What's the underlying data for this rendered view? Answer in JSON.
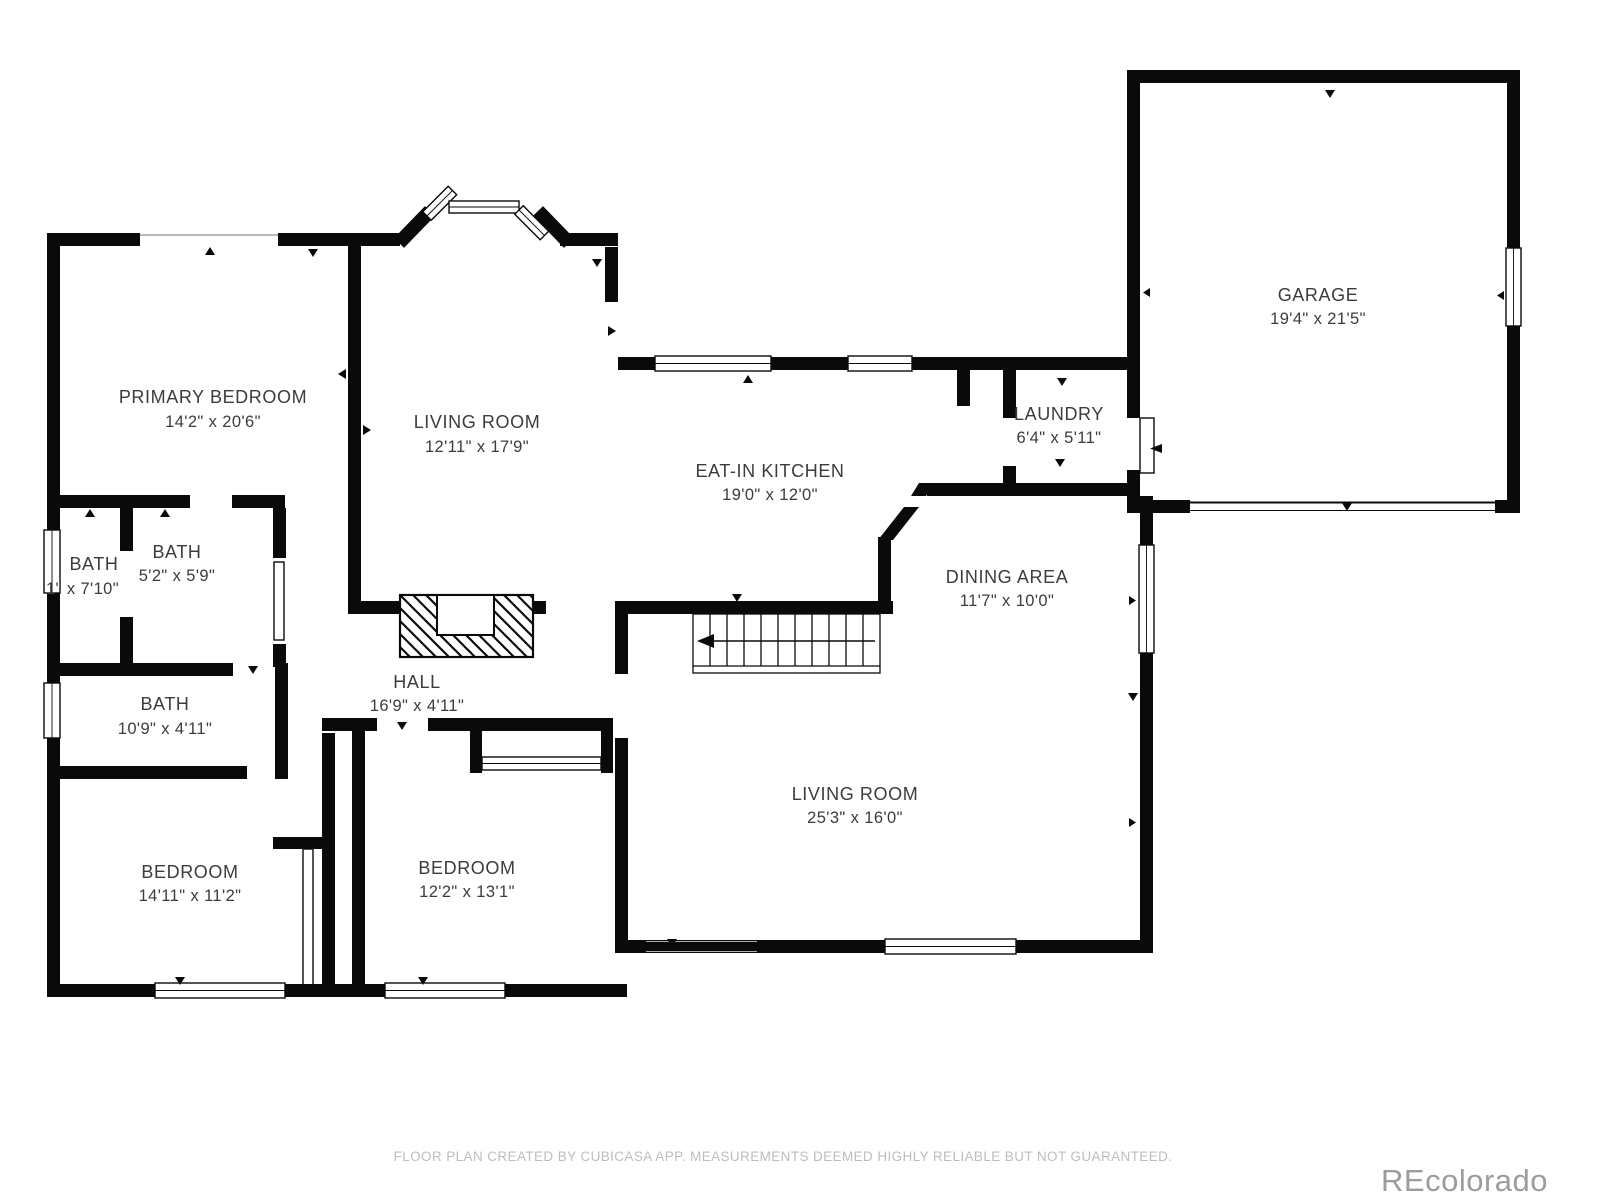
{
  "footer": {
    "text": "FLOOR PLAN CREATED BY CUBICASA APP. MEASUREMENTS DEEMED HIGHLY RELIABLE BUT NOT GUARANTEED."
  },
  "watermark": {
    "text": "REcolorado"
  },
  "colors": {
    "wall": "#0a0a0a",
    "label": "#3c3c3c",
    "footer_text": "#bdbdbd",
    "watermark_text": "#9c9c9c",
    "background": "#ffffff"
  },
  "rooms": [
    {
      "name": "PRIMARY BEDROOM",
      "dims": "14'2\" x 20'6\""
    },
    {
      "name": "LIVING ROOM",
      "dims": "12'11\" x 17'9\""
    },
    {
      "name": "EAT-IN KITCHEN",
      "dims": "19'0\" x 12'0\""
    },
    {
      "name": "LAUNDRY",
      "dims": "6'4\" x 5'11\""
    },
    {
      "name": "GARAGE",
      "dims": "19'4\" x 21'5\""
    },
    {
      "name": "DINING AREA",
      "dims": "11'7\" x 10'0\""
    },
    {
      "name": "BATH",
      "dims": "1\" x 7'10\""
    },
    {
      "name": "BATH",
      "dims": "5'2\" x 5'9\""
    },
    {
      "name": "BATH",
      "dims": "10'9\" x 4'11\""
    },
    {
      "name": "HALL",
      "dims": "16'9\" x 4'11\""
    },
    {
      "name": "BEDROOM",
      "dims": "14'11\" x 11'2\""
    },
    {
      "name": "BEDROOM",
      "dims": "12'2\" x 13'1\""
    },
    {
      "name": "LIVING ROOM",
      "dims": "25'3\" x 16'0\""
    }
  ]
}
